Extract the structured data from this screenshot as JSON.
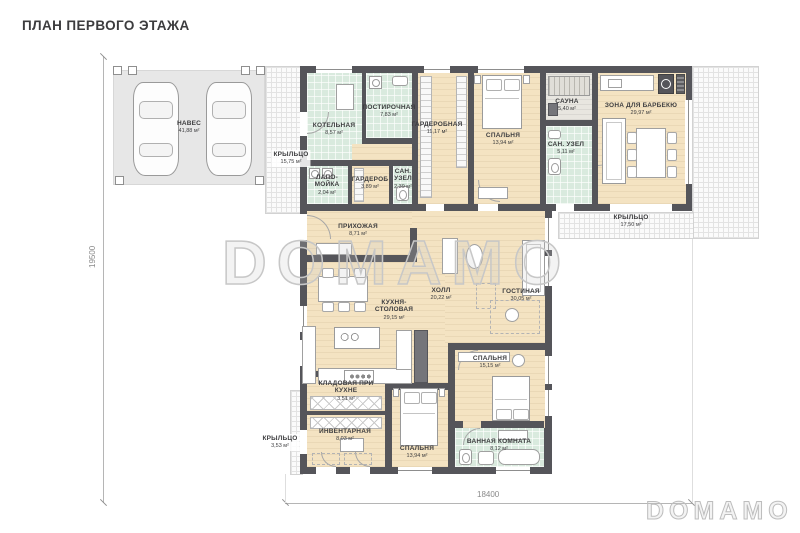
{
  "header": {
    "title": "ПЛАН ПЕРВОГО ЭТАЖА"
  },
  "watermarks": {
    "center": "DOMAMO",
    "corner": "DOMAMO"
  },
  "dimensions": {
    "vertical": "19500",
    "horizontal": "18400"
  },
  "colors": {
    "wall": "#55555a",
    "floor_wood": "#f4e3c2",
    "floor_tile": "#d9eade",
    "floor_sauna": "#e8e6e0",
    "carport_slab": "#e7e7e7"
  },
  "rooms": {
    "naves": {
      "name": "НАВЕС",
      "area": "41,88 м²"
    },
    "kryltso_left": {
      "name": "КРЫЛЬЦО",
      "area": "15,75 м²"
    },
    "kotelnaya": {
      "name": "КОТЕЛЬНАЯ",
      "area": "8,57 м²"
    },
    "postirochnaya": {
      "name": "ПОСТИРОЧНАЯ",
      "area": "7,83 м²"
    },
    "garderobnaya": {
      "name": "ГАРДЕРОБНАЯ",
      "area": "11,17 м²"
    },
    "spalnya_top": {
      "name": "СПАЛЬНЯ",
      "area": "13,94 м²"
    },
    "sauna": {
      "name": "САУНА",
      "area": "5,40 м²"
    },
    "san_uzel_sauna": {
      "name": "САН. УЗЕЛ",
      "area": "5,11 м²"
    },
    "barbekyu": {
      "name": "ЗОНА ДЛЯ БАРБЕКЮ",
      "area": "29,97 м²"
    },
    "kryltso_right": {
      "name": "КРЫЛЬЦО",
      "area": "17,50 м²"
    },
    "lapomoyka": {
      "name": "ЛАПО-МОЙКА",
      "area": "2,04 м²"
    },
    "garderob": {
      "name": "ГАРДЕРОБ",
      "area": "3,89 м²"
    },
    "san_uzel_small": {
      "name": "САН. УЗЕЛ",
      "area": "2,39 м²"
    },
    "prihozhaya": {
      "name": "ПРИХОЖАЯ",
      "area": "8,71 м²"
    },
    "holl": {
      "name": "ХОЛЛ",
      "area": "20,22 м²"
    },
    "gostinaya": {
      "name": "ГОСТИНАЯ",
      "area": "30,05 м²"
    },
    "kuhnya": {
      "name": "КУХНЯ-СТОЛОВАЯ",
      "area": "29,15 м²"
    },
    "spalnya_mid": {
      "name": "СПАЛЬНЯ",
      "area": "15,15 м²"
    },
    "kladovaya": {
      "name": "КЛАДОВАЯ ПРИ КУХНЕ",
      "area": "3,51 м²"
    },
    "inventarnaya": {
      "name": "ИНВЕНТАРНАЯ",
      "area": "8,03 м²"
    },
    "kryltso_bottom": {
      "name": "КРЫЛЬЦО",
      "area": "3,53 м²"
    },
    "spalnya_bottom": {
      "name": "СПАЛЬНЯ",
      "area": "13,94 м²"
    },
    "vannaya": {
      "name": "ВАННАЯ КОМНАТА",
      "area": "8,12 м²"
    }
  }
}
